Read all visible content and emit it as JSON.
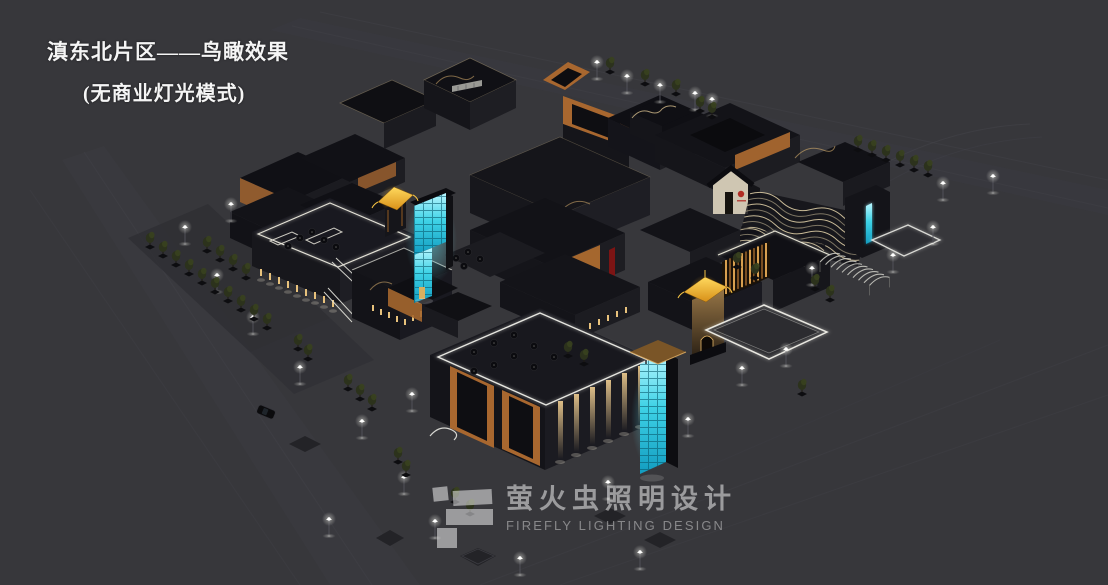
{
  "title": {
    "line1": "滇东北片区——鸟瞰效果",
    "line2": "(无商业灯光模式)"
  },
  "watermark": {
    "cn": "萤火虫照明设计",
    "en": "FIREFLY LIGHTING DESIGN",
    "logo": "firefly-blocks-logo"
  },
  "colors": {
    "background": "#37373b",
    "ground-road": "#3d3d43",
    "parking": "#2f2f34",
    "roof-dark": "#0e0e12",
    "wall-dark": "#17171c",
    "wall-mid": "#1e1e24",
    "wood": "#a8672f",
    "wood-bright": "#c07c38",
    "eave-light": "#dcc globale",
    "eave": "#d9c491",
    "cyan": "#3ed2e6",
    "cyan-bright": "#b8f6ff",
    "gold": "#f0b429",
    "lamp-white": "#f5f5f0",
    "red-accent": "#7c1414",
    "sign-red": "#b02c24",
    "watermark": "rgba(255,255,255,0.5)",
    "watermark-dim": "rgba(255,255,255,0.40)"
  }
}
